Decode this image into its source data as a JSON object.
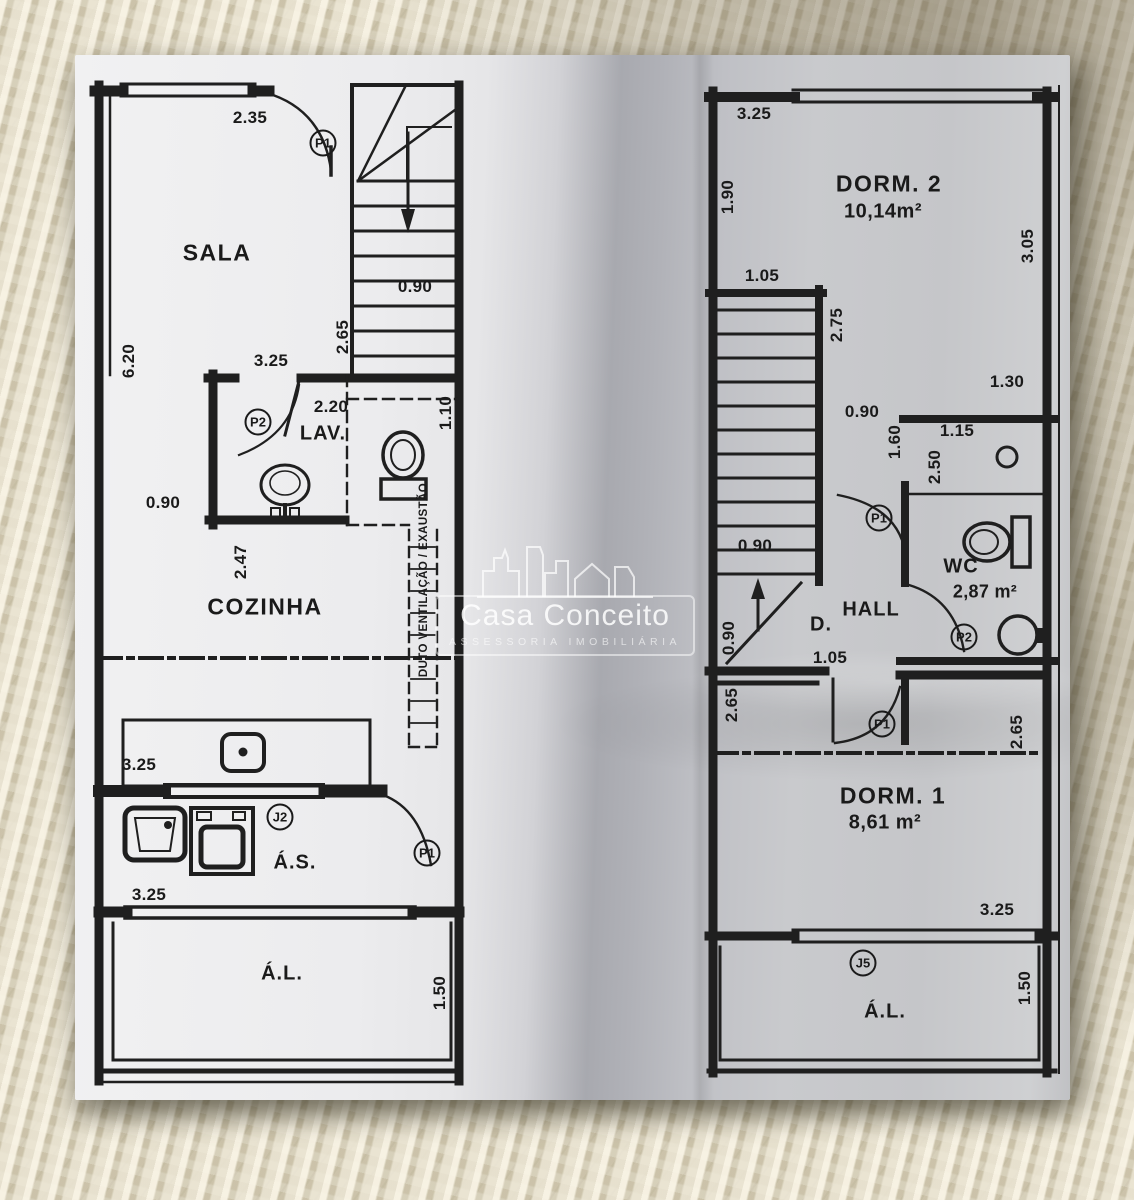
{
  "watermark": {
    "brand": "Casa Conceito",
    "tagline": "ASSESSORIA IMOBILIÁRIA"
  },
  "left": {
    "rooms": {
      "sala": "SALA",
      "lav": "LAV.",
      "cozinha": "COZINHA",
      "servico": "Á.S.",
      "livre": "Á.L."
    },
    "tags": {
      "sala_door": "P1",
      "lav_door": "P2",
      "servico_window": "J2",
      "servico_door": "P1"
    },
    "duct": "DUTO VENTILAÇÃO / EXAUSTÃO",
    "dims": {
      "top_width": "2.35",
      "stair_width": "0.90",
      "stair_run": "2.65",
      "sala_width": "3.25",
      "sala_depth": "6.20",
      "lav_width": "2.20",
      "duct_depth": "1.10",
      "passage": "0.90",
      "cozinha_depth": "2.47",
      "cozinha_width": "3.25",
      "servico_width": "3.25",
      "livre_depth": "1.50"
    }
  },
  "right": {
    "rooms": {
      "dorm2": "DORM. 2",
      "dorm2_area": "10,14m²",
      "wc": "WC",
      "wc_area": "2,87 m²",
      "hall": "HALL",
      "duct": "D.",
      "dorm1": "DORM. 1",
      "dorm1_area": "8,61 m²",
      "livre": "Á.L."
    },
    "tags": {
      "hall_door": "P1",
      "wc_door": "P2",
      "dorm1_door": "P1",
      "livre_window": "J5"
    },
    "dims": {
      "top_width": "3.25",
      "dorm2_left": "1.90",
      "dorm2_side": "3.05",
      "stair_top": "1.05",
      "stair_run": "2.75",
      "side_right": "1.30",
      "hall_top": "0.90",
      "wc_entry": "1.60",
      "wc_width": "1.15",
      "wc_depth": "2.50",
      "stair_width": "0.90",
      "stair_base": "0.90",
      "hall_width": "1.05",
      "dorm1_left": "2.65",
      "dorm1_right": "2.65",
      "dorm1_width": "3.25",
      "livre_depth": "1.50"
    }
  }
}
